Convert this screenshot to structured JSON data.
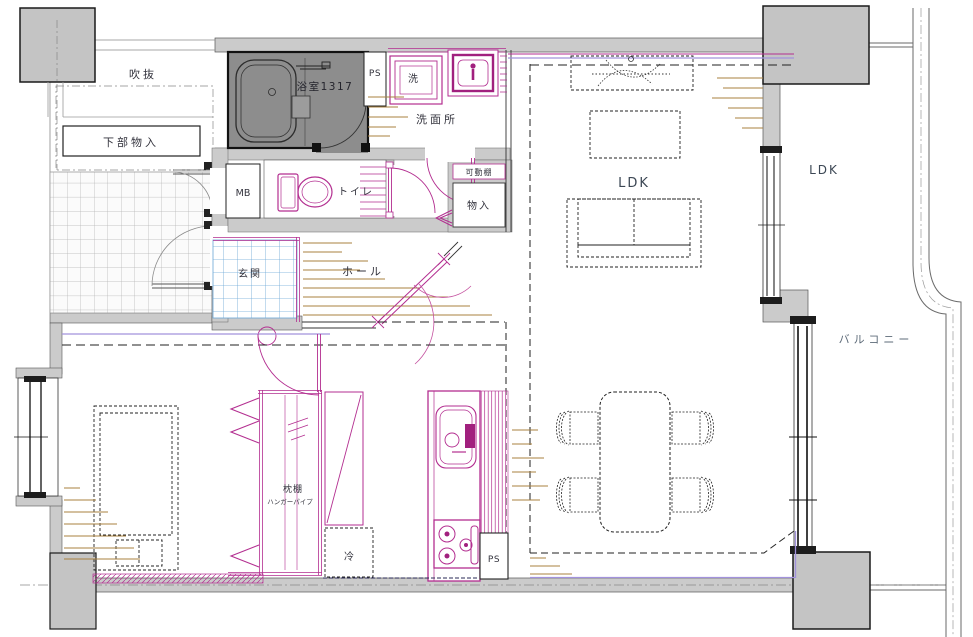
{
  "title": "apartment-floor-plan",
  "labels": {
    "void": "吹抜",
    "under_storage": "下部物入",
    "bathroom": "浴室1317",
    "ps_top": "PS",
    "washer": "洗",
    "washroom": "洗面所",
    "mb": "MB",
    "toilet": "トイレ",
    "movable_shelf": "可動棚",
    "storage": "物入",
    "genkan": "玄関",
    "hall": "ホール",
    "ldk_main": "LDK",
    "ldk_outer": "LDK",
    "balcony": "バルコニー",
    "pillow_shelf": "枕棚",
    "hanger_pipe": "ハンガーパイプ",
    "fridge": "冷",
    "ps_bottom": "PS"
  },
  "colors": {
    "fixture_magenta": "#b32e90",
    "fixture_magenta_dark": "#a1207e",
    "tile_blue": "#6aa6d6",
    "wood_brown": "#a8813f",
    "accent_purple": "#a292dc",
    "wall_gray": "#cbcbcb",
    "column_gray": "#c4c4c4",
    "bath_gray": "#8d8d8d",
    "line_dark": "#333333",
    "navy_dash": "#2a2a55"
  }
}
